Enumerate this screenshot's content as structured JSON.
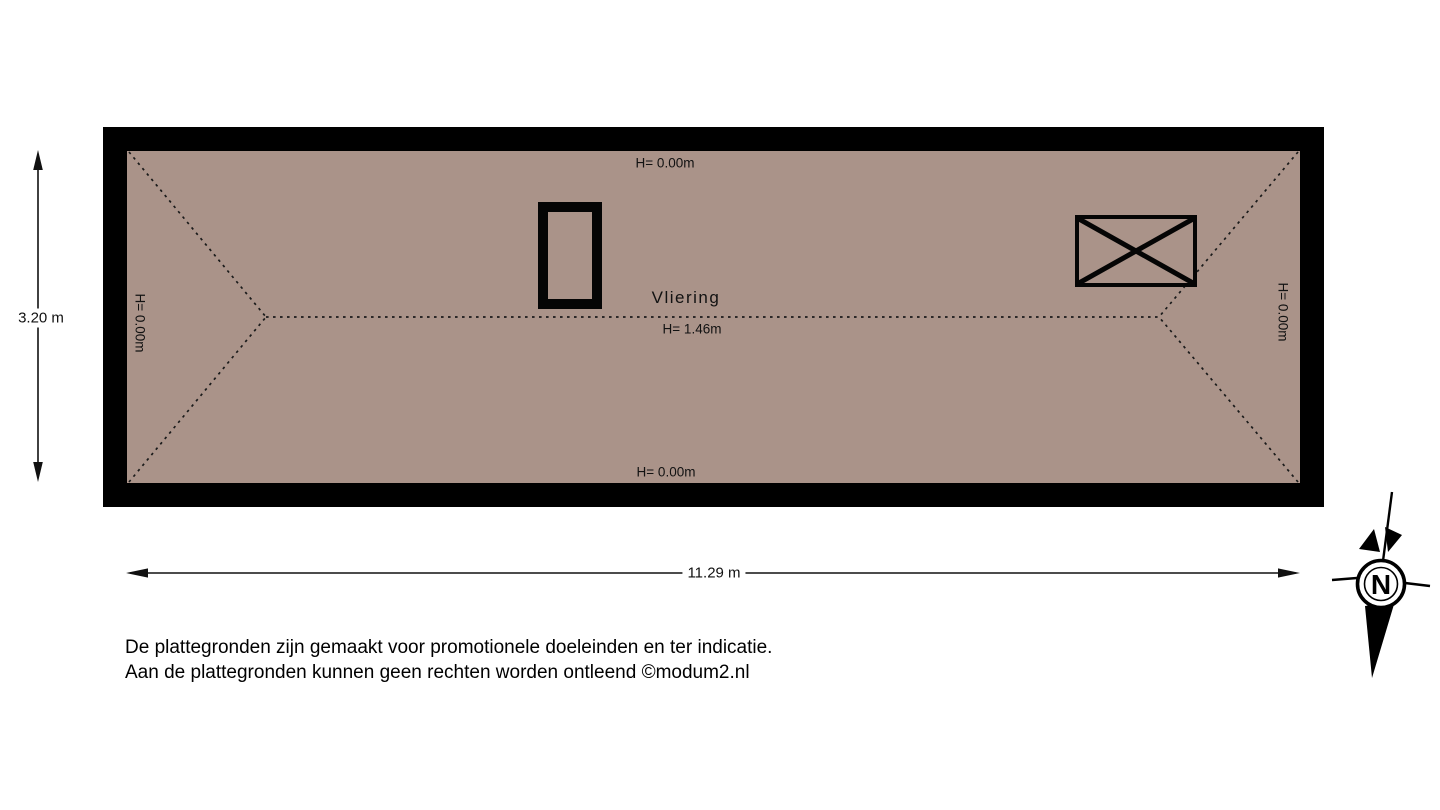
{
  "floorplan": {
    "room": {
      "label": "Vliering",
      "ridge_height": "H= 1.46m"
    },
    "heights": {
      "top": "H= 0.00m",
      "bottom": "H= 0.00m",
      "left": "H= 0.00m",
      "right": "H= 0.00m"
    },
    "dimensions": {
      "width": "11.29 m",
      "depth": "3.20 m"
    },
    "colors": {
      "floor": "#aa9389",
      "wall": "#000000",
      "roofline": "#1a1a1a"
    }
  },
  "compass": {
    "north_label": "N"
  },
  "disclaimer": {
    "line1": "De plattegronden zijn gemaakt voor promotionele doeleinden en ter indicatie.",
    "line2": "Aan de plattegronden kunnen geen rechten worden ontleend ©modum2.nl"
  }
}
